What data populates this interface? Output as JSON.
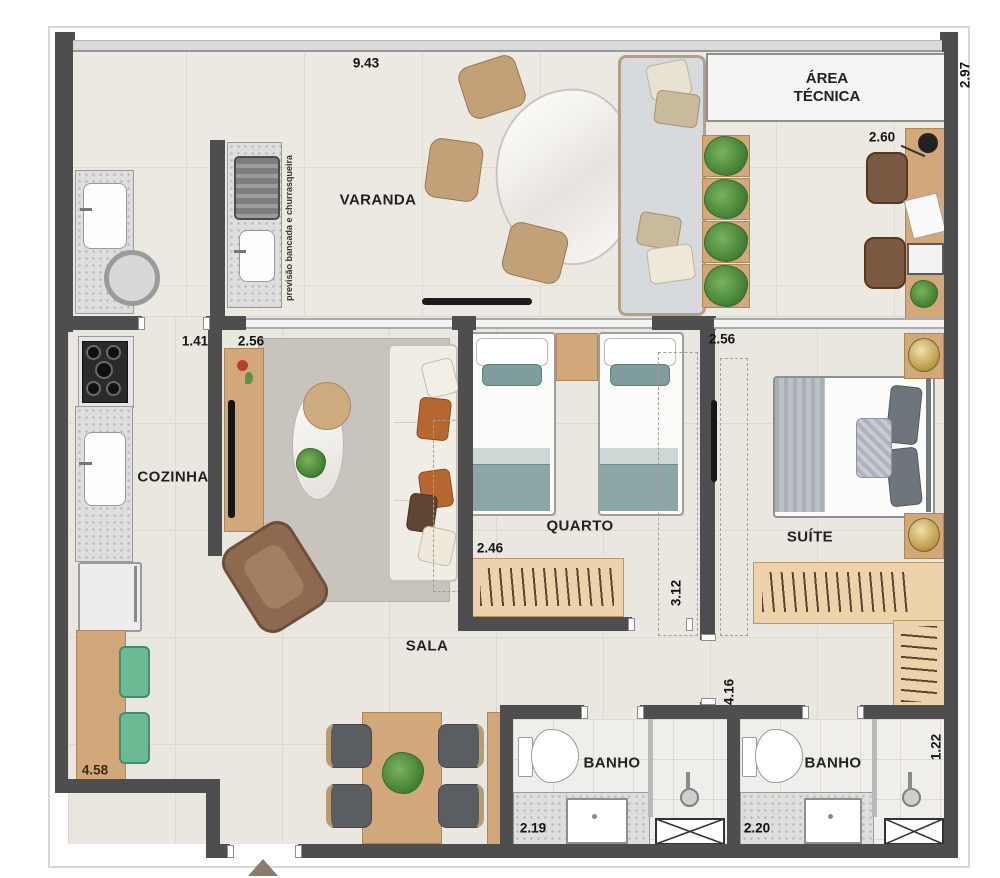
{
  "plan": {
    "rooms": {
      "varanda": "VARANDA",
      "area_tecnica": "ÁREA TÉCNICA",
      "cozinha": "COZINHA",
      "sala": "SALA",
      "quarto": "QUARTO",
      "suite": "SUÍTE",
      "banho1": "BANHO",
      "banho2": "BANHO"
    },
    "notes": {
      "churrasqueira": "previsão bancada e churrasqueira"
    },
    "dimensions": {
      "varanda_width": "9.43",
      "right_depth": "2.97",
      "office_width": "2.60",
      "kitchen_opening": "1.41",
      "sala_opening": "2.56",
      "suite_width": "2.56",
      "quarto_width": "2.46",
      "quarto_depth": "3.12",
      "suite_depth": "4.16",
      "kitchen_depth": "4.58",
      "banho1_width": "2.19",
      "banho2_width": "2.20",
      "shower_width": "1.22"
    },
    "colors": {
      "wall": "#4e4e4e",
      "floor": "#eae7e1",
      "wood": "#d2a87a",
      "teal": "#8ca6a5",
      "plant_green": "#4f8f3f",
      "stool_green": "#6cba93"
    }
  }
}
